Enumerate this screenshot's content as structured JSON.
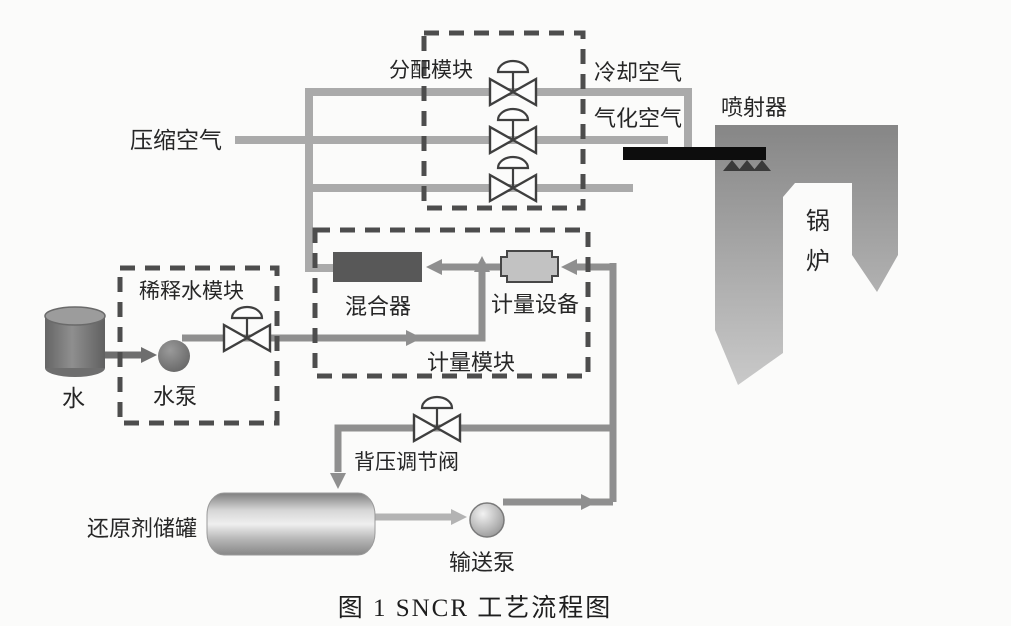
{
  "caption": "图 1  SNCR 工艺流程图",
  "modules": {
    "distribution": "分配模块",
    "dilution_water": "稀释水模块",
    "metering": "计量模块"
  },
  "streams": {
    "compressed_air": "压缩空气",
    "cooling_air": "冷却空气",
    "atomizing_air": "气化空气"
  },
  "equipment": {
    "injector": "喷射器",
    "boiler": "锅炉",
    "water": "水",
    "water_pump": "水泵",
    "mixer": "混合器",
    "metering_device": "计量设备",
    "back_pressure_valve": "背压调节阀",
    "reducing_agent_tank": "还原剂储罐",
    "transfer_pump": "输送泵"
  },
  "colors": {
    "pipe_light": "#aaaaaa",
    "pipe_mid": "#8f8f8f",
    "pipe_dark": "#6e6e6e",
    "module_border_dash": "#4d4d4d",
    "valve_outline": "#3f3f3f",
    "mixer_fill": "#585858",
    "metering_device_fill": "#c2c2c2",
    "injector_bar": "#0d0d0d",
    "boiler_top": "#868686",
    "boiler_bottom": "#c9c9c9",
    "text": "#262626",
    "background": "#fbfbfa"
  }
}
